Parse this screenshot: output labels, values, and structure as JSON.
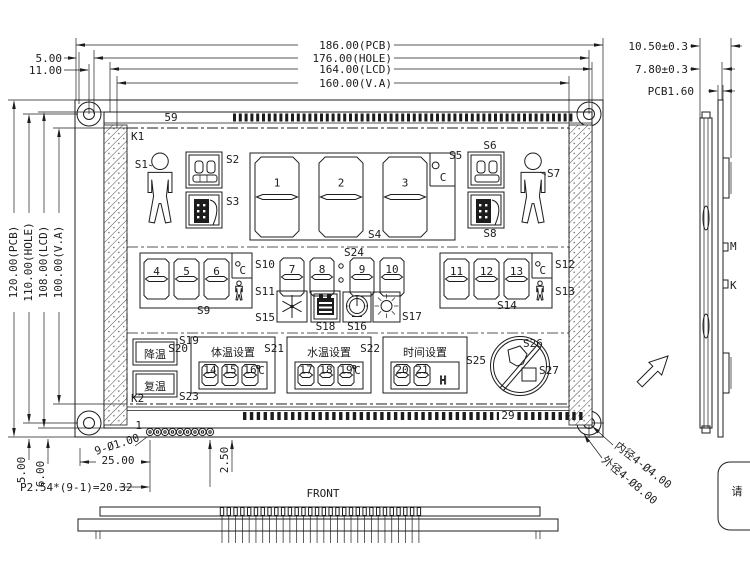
{
  "views": {
    "front_label": "FRONT"
  },
  "dims": {
    "top": [
      "186.00(PCB)",
      "176.00(HOLE)",
      "164.00(LCD)",
      "160.00(V.A)"
    ],
    "top_left": [
      "5.00",
      "11.00"
    ],
    "left": [
      "120.00(PCB)",
      "110.00(HOLE)",
      "108.00(LCD)",
      "100.00(V.A)"
    ],
    "side": [
      "10.50±0.3",
      "7.80±0.3",
      "PCB1.60"
    ],
    "bottom": {
      "v_left1": "5.00",
      "v_left2": "6.00",
      "h_pins": "25.00",
      "v_right": "2.50",
      "pitch": "P2.54*(9-1)=20.32",
      "pin_dia": "9-Ø1.00",
      "pin_first": "1"
    },
    "corner_hole": {
      "inner": "内径4-Ø4.00",
      "outer": "外径4-Ø8.00"
    }
  },
  "side_view": {
    "tab_top": "M",
    "tab_bottom": "K"
  },
  "note": {
    "text": "请"
  },
  "lcd": {
    "corner_top": "K1",
    "corner_bottom": "K2",
    "pad_count_top": "59",
    "pad_count_bottom": "29",
    "celsius": "C",
    "digits_main": [
      "1",
      "2",
      "3"
    ],
    "digits_temp_left": [
      "4",
      "5",
      "6"
    ],
    "digits_time": [
      "7",
      "8",
      "9",
      "10"
    ],
    "digits_temp_right": [
      "11",
      "12",
      "13"
    ],
    "buttons": {
      "cool": "降温",
      "rewarm": "复温"
    },
    "set_body": {
      "title": "体温设置",
      "digits": [
        "14",
        "15",
        "16"
      ]
    },
    "set_water": {
      "title": "水温设置",
      "digits": [
        "17",
        "18",
        "19"
      ]
    },
    "set_time": {
      "title": "时间设置",
      "digits": [
        "20",
        "21",
        "H"
      ]
    },
    "labels": {
      "s1": "S1",
      "s2": "S2",
      "s3": "S3",
      "s4": "S4",
      "s5": "S5",
      "s6": "S6",
      "s7": "S7",
      "s8": "S8",
      "s9": "S9",
      "s10": "S10",
      "s11": "S11",
      "s12": "S12",
      "s13": "S13",
      "s14": "S14",
      "s15": "S15",
      "s16": "S16",
      "s17": "S17",
      "s18": "S18",
      "s19": "S19",
      "s20": "S20",
      "s21": "S21",
      "s22": "S22",
      "s23": "S23",
      "s24": "S24",
      "s25": "S25",
      "s26": "S26",
      "s27": "S27"
    }
  }
}
